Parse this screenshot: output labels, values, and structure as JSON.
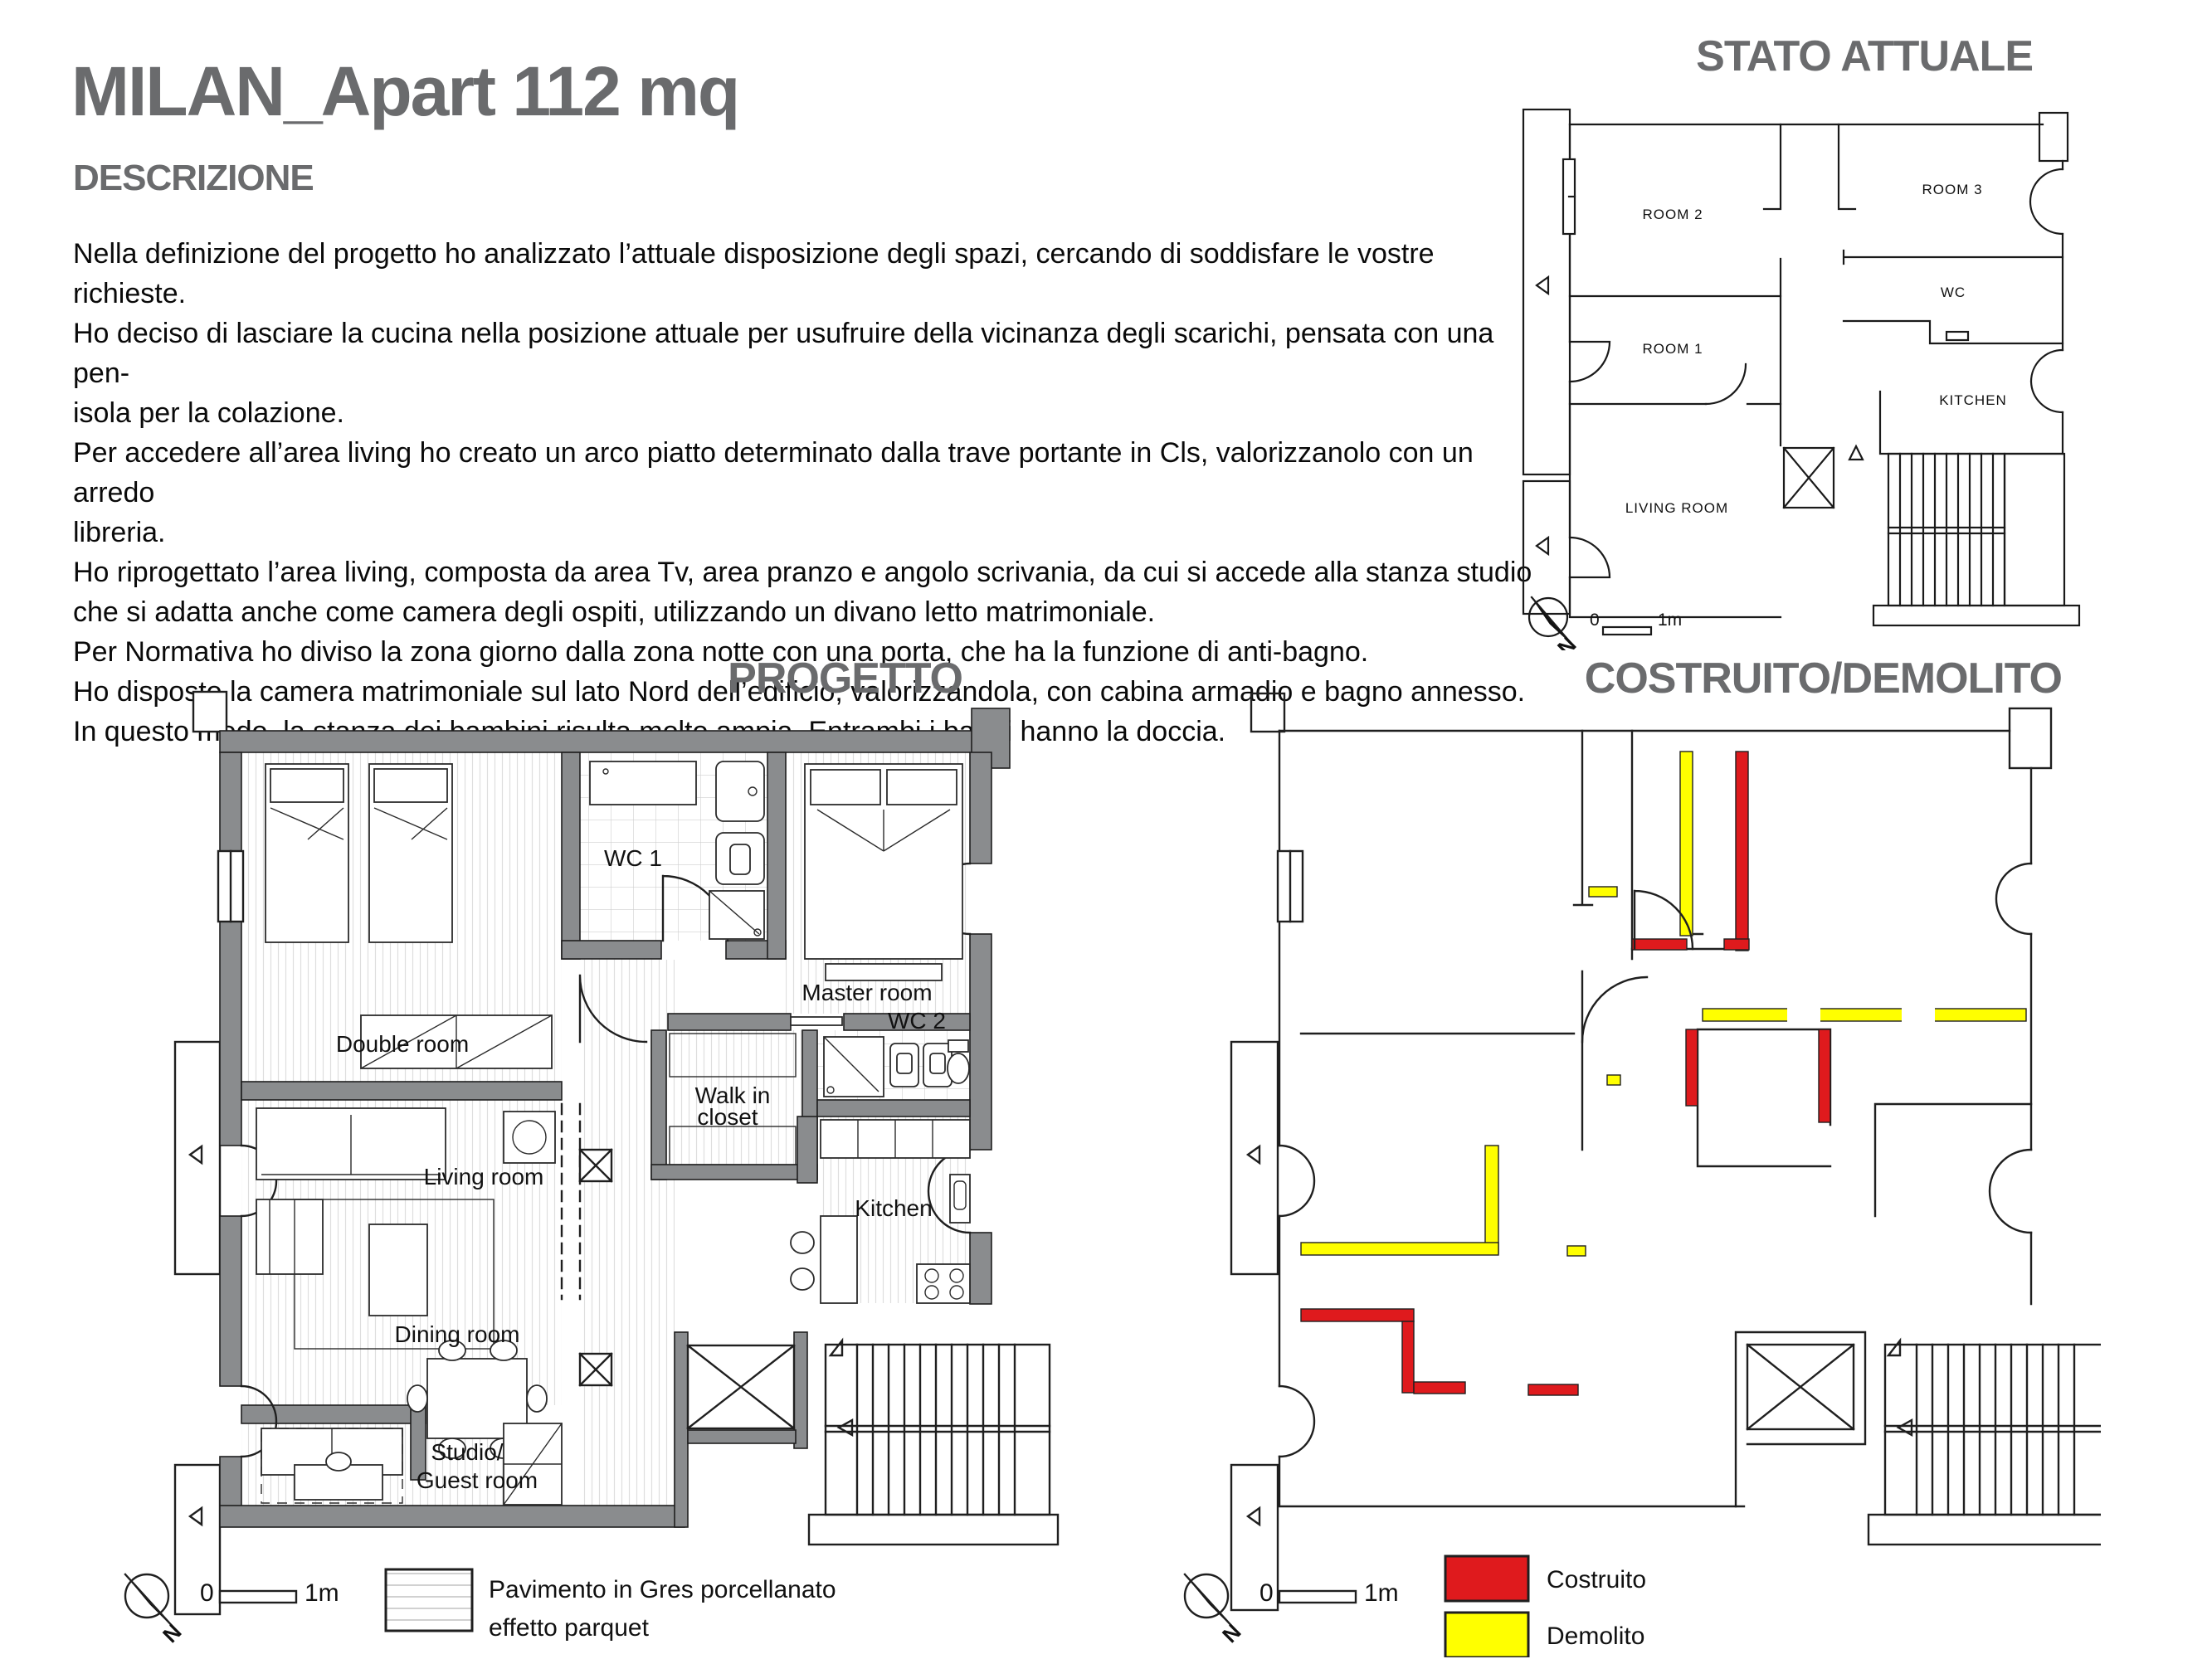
{
  "header": {
    "title": "MILAN_Apart 112 mq",
    "section_label": "DESCRIZIONE",
    "description": "Nella definizione del progetto ho analizzato l’attuale disposizione degli spazi, cercando di soddisfare le vostre richieste.\nHo deciso di lasciare la cucina nella posizione attuale per usufruire della vicinanza degli scarichi, pensata con una pen-\nisola per la colazione.\nPer accedere all’area living ho creato un arco piatto determinato dalla trave portante in Cls, valorizzanolo con un arredo\nlibreria.\nHo riprogettato l’area living, composta da area Tv, area pranzo e angolo scrivania, da cui si accede alla stanza studio\nche si adatta anche come camera degli ospiti, utilizzando un divano letto matrimoniale.\nPer Normativa ho diviso la zona giorno dalla zona notte con una porta, che ha la funzione di anti-bagno.\nHo disposto la camera matrimoniale sul lato Nord dell’edificio, valorizzandola, con cabina armadio e bagno annesso.\nIn questo modo, la stanza dei bambini risulta molto ampia. Entrambi i bagni hanno la doccia."
  },
  "stato_attuale": {
    "title": "STATO ATTUALE",
    "rooms": {
      "room2": "ROOM 2",
      "room3": "ROOM 3",
      "room1": "ROOM 1",
      "wc": "WC",
      "kitchen": "KITCHEN",
      "living": "LIVING ROOM"
    },
    "scale": {
      "zero": "0",
      "unit": "1m"
    },
    "compass_n": "N"
  },
  "progetto": {
    "title": "PROGETTO",
    "rooms": {
      "double": "Double room",
      "wc1": "WC 1",
      "master": "Master room",
      "walkin1": "Walk in",
      "walkin2": "closet",
      "wc2": "WC 2",
      "living": "Living room",
      "dining": "Dining room",
      "kitchen": "Kitchen",
      "studio1": "Studio/",
      "studio2": "Guest room"
    },
    "scale": {
      "zero": "0",
      "unit": "1m"
    },
    "compass_n": "N",
    "floor_legend": {
      "line1": "Pavimento in Gres porcellanato",
      "line2": "effetto parquet"
    }
  },
  "costruito_demolito": {
    "title": "COSTRUITO/DEMOLITO",
    "scale": {
      "zero": "0",
      "unit": "1m"
    },
    "compass_n": "N",
    "legend": {
      "costruito": {
        "label": "Costruito",
        "color": "#df1a1d"
      },
      "demolito": {
        "label": "Demolito",
        "color": "#ffff00"
      }
    }
  },
  "colors": {
    "title_gray": "#6a6b6d",
    "wall_gray": "#8a8c8e",
    "built_red": "#df1a1d",
    "demolished_yellow": "#ffff00"
  }
}
